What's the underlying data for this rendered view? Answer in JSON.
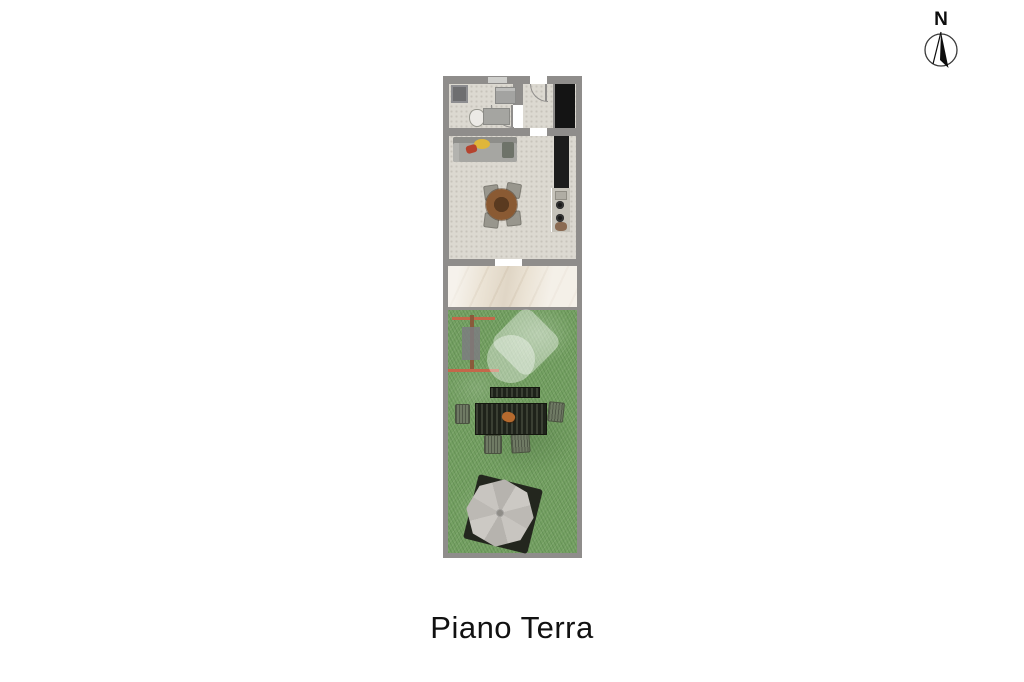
{
  "title": "Piano Terra",
  "compass": {
    "label": "N"
  },
  "colors": {
    "background": "#ffffff",
    "wall": "#8f8d8b",
    "floor": "#dcd9d1",
    "void": "#141414",
    "marble": "#ebe3d5",
    "grass": "#75a163",
    "counter": "#c6c3ba",
    "kitchenTall": "#1c1c1c",
    "sofa": "#a6a6a2",
    "cushionYellow": "#dfb63a",
    "pillowRed": "#b5432e",
    "tableWood": "#8a5a33",
    "tableWoodDark": "#5a3a20",
    "chairGray": "#98968d",
    "outdoorChair": "#6f7a64",
    "orangeRail": "#c4674a",
    "woodPost": "#8a5a3a",
    "grayPanel": "#7d7d80",
    "watermarkFill": "rgba(255,255,255,0.38)",
    "text": "#111111"
  },
  "plan": {
    "floor_label": "Piano Terra",
    "sections": [
      {
        "name": "bathroom",
        "features": [
          "shower",
          "washing-machine",
          "toilet",
          "sink-vanity",
          "door-swing"
        ]
      },
      {
        "name": "entry-hall",
        "features": [
          "entry-door-swing",
          "stair-void"
        ]
      },
      {
        "name": "living-room",
        "features": [
          "sofa",
          "yellow-cushion",
          "red-pillow",
          "side-table",
          "round-dining-table",
          "four-chairs",
          "kitchen-tall-units",
          "kitchen-counter",
          "sink",
          "cooktop-burners"
        ]
      },
      {
        "name": "patio",
        "features": [
          "marble-paving"
        ]
      },
      {
        "name": "garden",
        "features": [
          "grass-lawn",
          "garden-rack",
          "watermark-logo",
          "outdoor-bench",
          "slatted-outdoor-table",
          "outdoor-chairs",
          "parasol",
          "parasol-base"
        ]
      }
    ]
  }
}
